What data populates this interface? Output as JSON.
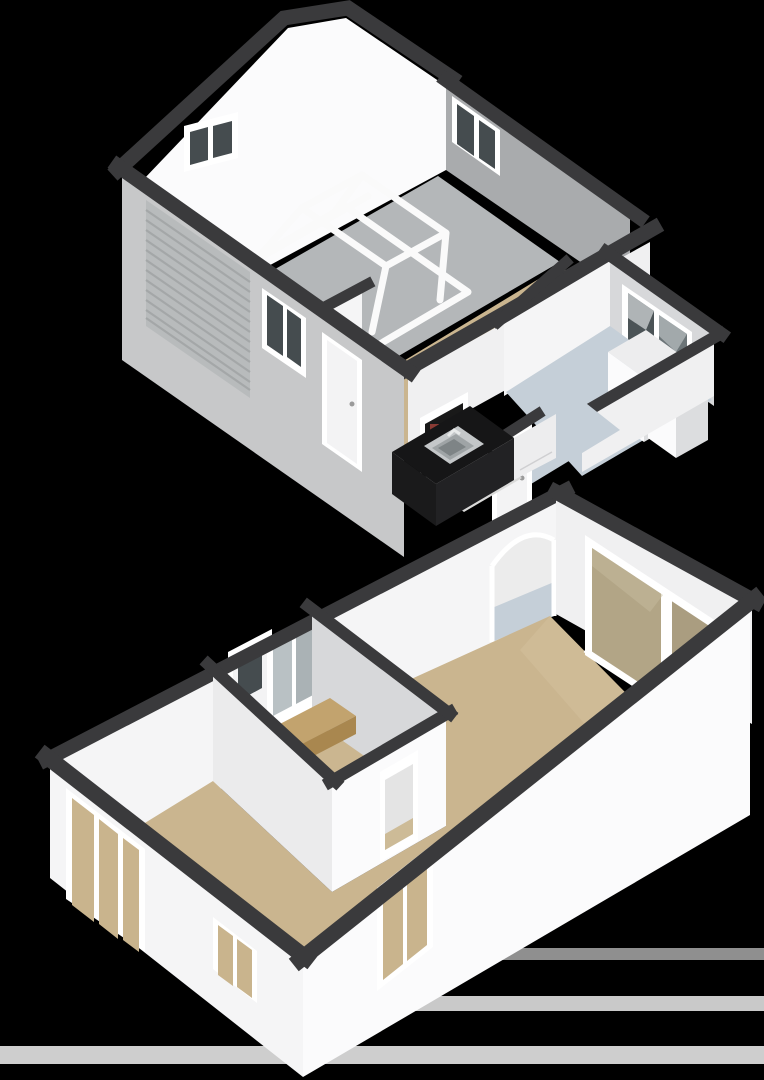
{
  "scene": {
    "kind": "isometric-3d-floorplan-render",
    "view": "cutaway birds-eye, rotated south-west",
    "background": "#000000",
    "visible_text": ""
  },
  "colors": {
    "background": "#000000",
    "cut_band": "#3a3a3c",
    "wall_white": "#f5f5f6",
    "wall_bright": "#fbfbfc",
    "wall_shaded": "#d7d8da",
    "wall_gray": "#a9abad",
    "wall_ext_light": "#c7c8c9",
    "wall_ext_white": "#f0f0f1",
    "floor_tan": "#cab58f",
    "floor_tan_light": "#d3c09c",
    "floor_gray": "#b4b7b9",
    "floor_blue": "#c5cfd8",
    "glass_dark": "#454c4f",
    "glass_tan": "#c9b48d",
    "glass_slider": "#b2a586",
    "garage_door": "#b8bbbc",
    "garage_door_rib": "#a4a7a8",
    "counter_black": "#161617",
    "counter_side": "#222224",
    "steel": "#c4c7c9",
    "step_tan": "#c2a36e",
    "step_side": "#a9874f",
    "box_white": "#ededee",
    "box_side": "#dcdddf",
    "door_white": "#f3f3f4",
    "frame_white": "#ffffff",
    "car_outline": "#fafafa",
    "reflection_strip": "#ededed",
    "red_accent": "#8a3b34"
  },
  "rooms": [
    {
      "id": "garage",
      "floor": "gray",
      "features": [
        "car-outline",
        "sectional-garage-door",
        "gable-roof-cut",
        "two-small-windows"
      ]
    },
    {
      "id": "garage-back-hall",
      "floor": "tan",
      "features": [
        "exterior-door",
        "window",
        "hatch-to-kitchen"
      ]
    },
    {
      "id": "kitchen",
      "floor": "pale",
      "features": [
        "black-l-counter",
        "inset-sink",
        "white-base-cabinet"
      ]
    },
    {
      "id": "utility-room",
      "floor": "blue",
      "features": [
        "large-window",
        "appliance-box-tall",
        "appliance-box-low"
      ]
    },
    {
      "id": "vestibule",
      "floor": "blue",
      "features": [
        "interior-door"
      ]
    },
    {
      "id": "entrance-hall",
      "floor": "tan",
      "features": [
        "front-door",
        "entry-step",
        "hall-door-opening"
      ]
    },
    {
      "id": "living-dining-room",
      "floor": "tan",
      "features": [
        "archway",
        "sliding-patio-door",
        "five-windows"
      ]
    }
  ],
  "elements": {
    "car_outline": "white wireframe car in garage",
    "garage_door": "ribbed sectional door, left exterior wall",
    "sliding_door_panels": 2,
    "appliance_boxes": 2,
    "arch": "arched wall opening between vestibule and dining area",
    "step": "raised entry step inside hall",
    "sink": "stainless inset sink on black counter",
    "reflection_strips": 3
  }
}
